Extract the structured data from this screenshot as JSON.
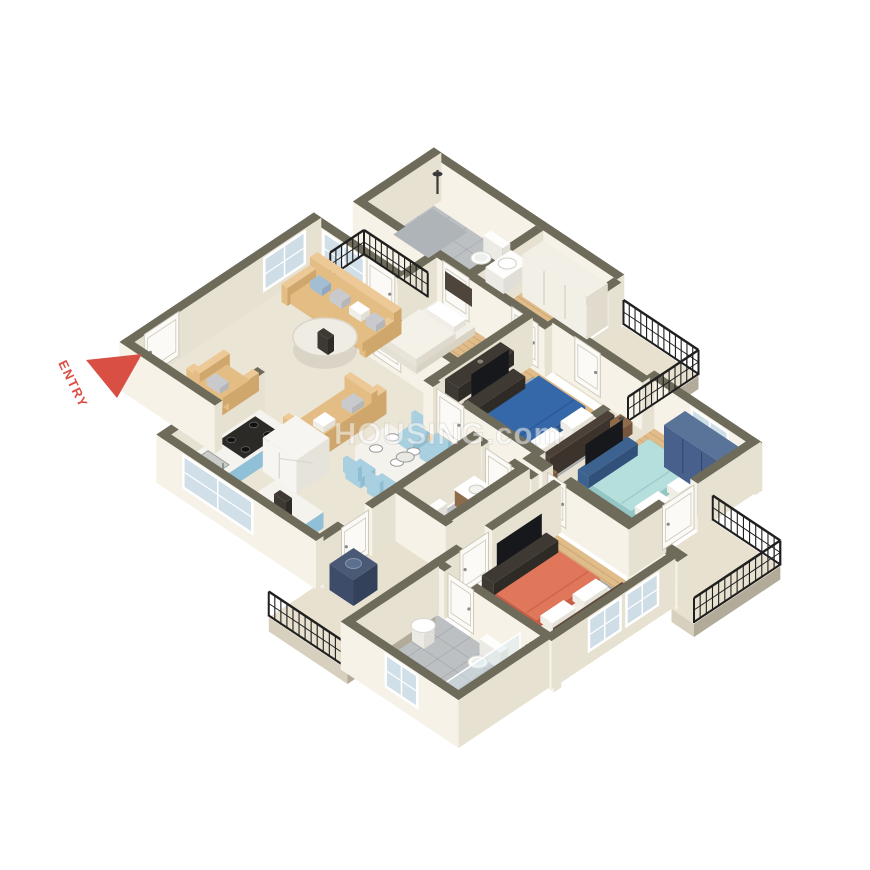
{
  "image": {
    "type": "isometric-3d-floor-plan",
    "description": "3D isometric floor plan of a 3 BHK apartment with living room, dining, kitchen, study, three bedrooms, three bathrooms and four balconies",
    "width": 870,
    "height": 870,
    "background": "#ffffff"
  },
  "watermark": {
    "text": "HOUSING.com",
    "color": "#ffffff",
    "opacity": 0.5
  },
  "entry": {
    "label": "ENTRY",
    "color": "#d94f43"
  },
  "rooms": [
    {
      "name": "living-room",
      "floor": "marble",
      "furniture": [
        "sofa-3-seater",
        "sofa-2-seater",
        "armchair",
        "round-coffee-table"
      ]
    },
    {
      "name": "dining-area",
      "floor": "marble",
      "furniture": [
        "dining-table",
        "dining-chairs-x6",
        "plates"
      ]
    },
    {
      "name": "kitchen",
      "floor": "marble",
      "furniture": [
        "blue-counter",
        "gas-stove",
        "sink",
        "refrigerator",
        "island-counter"
      ]
    },
    {
      "name": "study-room",
      "floor": "wood",
      "furniture": [
        "single-bed",
        "desk-unit",
        "wall-shelf"
      ]
    },
    {
      "name": "master-bedroom",
      "floor": "wood",
      "furniture": [
        "double-bed-blue",
        "white-wardrobe",
        "tv-unit",
        "nightstands",
        "rug"
      ]
    },
    {
      "name": "bedroom-2",
      "floor": "wood",
      "furniture": [
        "double-bed-cyan",
        "blue-wardrobe",
        "tv-unit",
        "accent-chair",
        "rug"
      ]
    },
    {
      "name": "bedroom-3",
      "floor": "wood",
      "furniture": [
        "double-bed-coral",
        "tv-unit",
        "nightstands",
        "rug"
      ]
    },
    {
      "name": "bathroom-1",
      "floor": "tile",
      "furniture": [
        "shower",
        "toilet",
        "washbasin"
      ]
    },
    {
      "name": "bathroom-2",
      "floor": "tile",
      "furniture": [
        "toilet",
        "vanity-washbasin"
      ]
    },
    {
      "name": "bathroom-3",
      "floor": "tile",
      "furniture": [
        "pedestal-washbasin",
        "toilet",
        "glass-shower"
      ]
    },
    {
      "name": "balcony-living",
      "floor": "balcony",
      "furniture": [
        "iron-railing"
      ]
    },
    {
      "name": "balcony-top-right",
      "floor": "balcony",
      "furniture": [
        "iron-railing"
      ]
    },
    {
      "name": "balcony-bottom-right",
      "floor": "balcony",
      "furniture": [
        "iron-railing"
      ]
    },
    {
      "name": "utility-balcony",
      "floor": "balcony",
      "furniture": [
        "iron-railing",
        "washing-machine"
      ]
    }
  ],
  "palette": {
    "wallTop": "#6e6b5b",
    "wallFaceL": "#f6f2e7",
    "wallFaceR": "#e7e1d2",
    "doorFace": "#fbfaf6",
    "doorEdge": "#cfc9bb",
    "glass": "#ccdde8",
    "floorMarble": "#ebe5d5",
    "floorWood": "#dfbc8a",
    "woodStripe": "#b98f58",
    "floorTile": "#bdc0c2",
    "tileLine": "#999ea1",
    "balconyFloor": "#e8e1d0",
    "railing": "#1f1f1f",
    "skirtL": "#d7d0bf",
    "skirtR": "#b2ab9a",
    "sofa": "#e4bd84",
    "sofaSide": "#cfa76d",
    "sofaTop": "#ecc996",
    "pillowBlue": "#a3bdd4",
    "pillowGray": "#c9cacd",
    "white": "#f7f5f0",
    "rug": "#b7bbbd",
    "rugLine": "#a3a7aa",
    "bedBlue": "#3468a8",
    "bedBlueSide": "#2a568e",
    "bedCyan": "#b5dfdc",
    "bedCyanSide": "#93c6c5",
    "frameNavy": "#3c6290",
    "bedCoral": "#e0775b",
    "bedCoralSide": "#c75f45",
    "headboard": "#4c4138",
    "headboardSide": "#3c342c",
    "woodFurn": "#8d6b4b",
    "woodFurnSide": "#74563c",
    "darkFurn": "#3e3a33",
    "darkFurnSide": "#2e2b26",
    "wardrobeWhite": "#f2efe7",
    "wardrobeWhiteSide": "#e0dbcc",
    "wardrobeBlue": "#47618c",
    "wardrobeBlueTop": "#5a7399",
    "kitchenCab": "#a9d2e5",
    "kitchenCabSide": "#8fc0d8",
    "counterTop": "#f5f3ed",
    "stoveDark": "#2b2a27",
    "applWhite": "#f6f5f1",
    "applWhiteSide": "#e6e3da",
    "chairBlue": "#a9d0e0",
    "chairBlueSide": "#8fbdd2",
    "tableWhite": "#f4f2ec",
    "tableSide": "#e2ded2",
    "entryRed": "#d94f43",
    "tvBlack": "#17181c",
    "washerNavy": "#3d4c68",
    "glassShower": "#d8e8f0",
    "toiletWhite": "#fdfdfb"
  }
}
